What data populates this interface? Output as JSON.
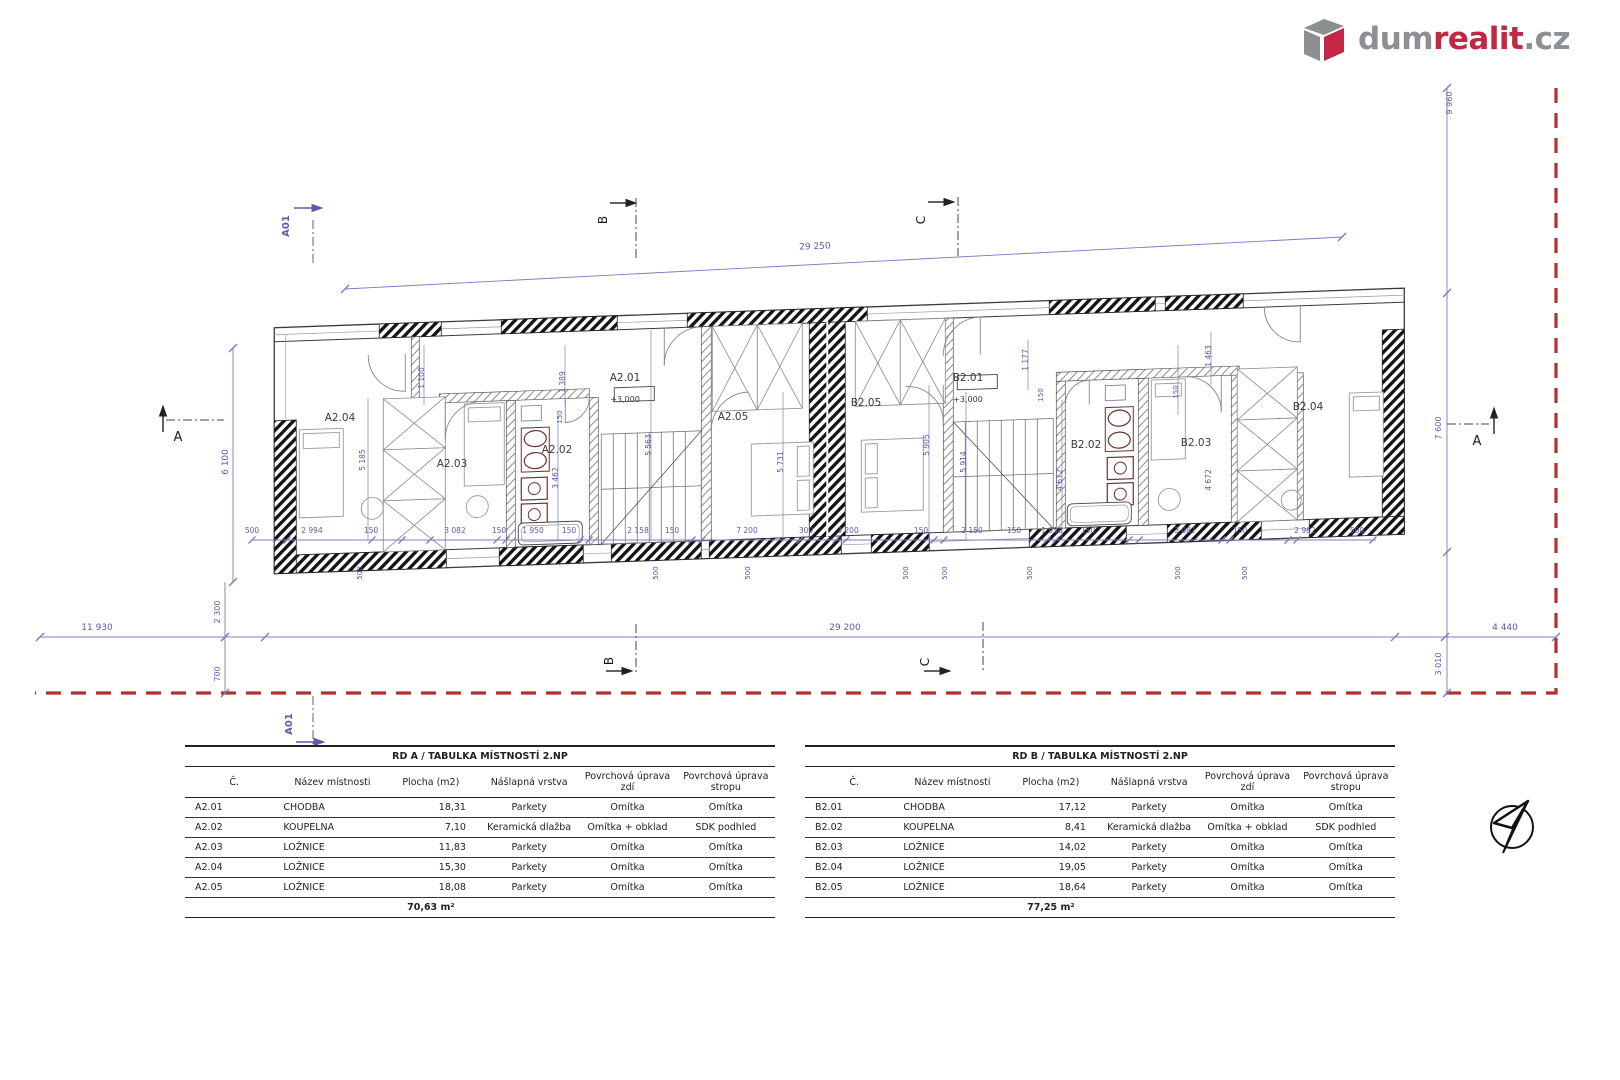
{
  "logo": {
    "dum": "dum",
    "realit": "realit",
    "cz": ".cz"
  },
  "tables": {
    "a": {
      "title": "RD A / TABULKA MÍSTNOSTÍ 2.NP",
      "headers": [
        "Č.",
        "Název místnosti",
        "Plocha (m2)",
        "Nášlapná vrstva",
        "Povrchová úprava zdí",
        "Povrchová úprava stropu"
      ],
      "rows": [
        [
          "A2.01",
          "CHODBA",
          "18,31",
          "Parkety",
          "Omítka",
          "Omítka"
        ],
        [
          "A2.02",
          "KOUPELNA",
          "7,10",
          "Keramická dlažba",
          "Omítka + obklad",
          "SDK podhled"
        ],
        [
          "A2.03",
          "LOŽNICE",
          "11,83",
          "Parkety",
          "Omítka",
          "Omítka"
        ],
        [
          "A2.04",
          "LOŽNICE",
          "15,30",
          "Parkety",
          "Omítka",
          "Omítka"
        ],
        [
          "A2.05",
          "LOŽNICE",
          "18,08",
          "Parkety",
          "Omítka",
          "Omítka"
        ]
      ],
      "total": "70,63 m²"
    },
    "b": {
      "title": "RD B / TABULKA MÍSTNOSTÍ 2.NP",
      "headers": [
        "Č.",
        "Název místnosti",
        "Plocha (m2)",
        "Nášlapná vrstva",
        "Povrchová úprava zdí",
        "Povrchová úprava stropu"
      ],
      "rows": [
        [
          "B2.01",
          "CHODBA",
          "17,12",
          "Parkety",
          "Omítka",
          "Omítka"
        ],
        [
          "B2.02",
          "KOUPELNA",
          "8,41",
          "Keramická dlažba",
          "Omítka + obklad",
          "SDK podhled"
        ],
        [
          "B2.03",
          "LOŽNICE",
          "14,02",
          "Parkety",
          "Omítka",
          "Omítka"
        ],
        [
          "B2.04",
          "LOŽNICE",
          "19,05",
          "Parkety",
          "Omítka",
          "Omítka"
        ],
        [
          "B2.05",
          "LOŽNICE",
          "18,64",
          "Parkety",
          "Omítka",
          "Omítka"
        ]
      ],
      "total": "77,25 m²"
    }
  },
  "plan": {
    "colors": {
      "dimension": "#5b5baa",
      "boundary": "#b23030",
      "wall": "#3a3a3a"
    },
    "labels": [
      {
        "n": "room-label-a2-04",
        "t": "A2.04",
        "x": 340,
        "y": 421,
        "cls": "room",
        "s": 10.5
      },
      {
        "n": "room-label-a2-03",
        "t": "A2.03",
        "x": 452,
        "y": 467,
        "cls": "room",
        "s": 10.5
      },
      {
        "n": "room-label-a2-02",
        "t": "A2.02",
        "x": 557,
        "y": 453,
        "cls": "room",
        "s": 10.5
      },
      {
        "n": "room-label-a2-01",
        "t": "A2.01",
        "x": 625,
        "y": 381,
        "cls": "room",
        "s": 10.5
      },
      {
        "n": "room-label-a2-05",
        "t": "A2.05",
        "x": 733,
        "y": 420,
        "cls": "room",
        "s": 10.5
      },
      {
        "n": "room-label-b2-05",
        "t": "B2.05",
        "x": 866,
        "y": 406,
        "cls": "room",
        "s": 10.5
      },
      {
        "n": "room-label-b2-01",
        "t": "B2.01",
        "x": 968,
        "y": 381,
        "cls": "room",
        "s": 10.5
      },
      {
        "n": "room-label-b2-02",
        "t": "B2.02",
        "x": 1086,
        "y": 448,
        "cls": "room",
        "s": 10.5
      },
      {
        "n": "room-label-b2-03",
        "t": "B2.03",
        "x": 1196,
        "y": 446,
        "cls": "room",
        "s": 10.5
      },
      {
        "n": "room-label-b2-04",
        "t": "B2.04",
        "x": 1308,
        "y": 410,
        "cls": "room",
        "s": 10.5
      },
      {
        "n": "elevation-label-a",
        "t": "+3,000",
        "x": 625,
        "y": 402,
        "cls": "room",
        "s": 8
      },
      {
        "n": "elevation-label-b",
        "t": "+3,000",
        "x": 968,
        "y": 402,
        "cls": "room",
        "s": 8
      },
      {
        "n": "dim-total-top",
        "t": "29 250",
        "x": 815,
        "y": 249,
        "cls": "dim",
        "s": 9,
        "r": -2.5
      },
      {
        "n": "dim-left-height",
        "t": "6 100",
        "x": 228,
        "y": 462,
        "cls": "dim",
        "s": 9,
        "r": -90
      },
      {
        "n": "dim-left-offset",
        "t": "11 930",
        "x": 97,
        "y": 630,
        "cls": "dim",
        "s": 9
      },
      {
        "n": "dim-building-length",
        "t": "29 200",
        "x": 845,
        "y": 630,
        "cls": "dim",
        "s": 9
      },
      {
        "n": "dim-right-offset",
        "t": "4 440",
        "x": 1505,
        "y": 630,
        "cls": "dim",
        "s": 9
      },
      {
        "n": "dim-2300",
        "t": "2 300",
        "x": 220,
        "y": 612,
        "cls": "dim",
        "s": 8,
        "r": -90
      },
      {
        "n": "dim-700",
        "t": "700",
        "x": 220,
        "y": 674,
        "cls": "dim",
        "s": 8,
        "r": -90
      },
      {
        "n": "dim-3010",
        "t": "3 010",
        "x": 1441,
        "y": 664,
        "cls": "dim",
        "s": 8,
        "r": -90
      },
      {
        "n": "dim-9960",
        "t": "9 960",
        "x": 1452,
        "y": 103,
        "cls": "dim",
        "s": 8,
        "r": -90
      },
      {
        "n": "dim-7600",
        "t": "7 600",
        "x": 1441,
        "y": 428,
        "cls": "dim",
        "s": 8,
        "r": -90
      },
      {
        "n": "dim-1100",
        "t": "1 100",
        "x": 424,
        "y": 378,
        "cls": "dim",
        "s": 7.5,
        "r": -90
      },
      {
        "n": "dim-5185",
        "t": "5 185",
        "x": 365,
        "y": 460,
        "cls": "dim",
        "s": 7.5,
        "r": -90
      },
      {
        "n": "dim-3462",
        "t": "3 462",
        "x": 558,
        "y": 478,
        "cls": "dim",
        "s": 7.5,
        "r": -90
      },
      {
        "n": "dim-1389",
        "t": "1 389",
        "x": 565,
        "y": 382,
        "cls": "dim",
        "s": 7.5,
        "r": -90
      },
      {
        "n": "dim-5563",
        "t": "5 563",
        "x": 651,
        "y": 445,
        "cls": "dim",
        "s": 7.5,
        "r": -90
      },
      {
        "n": "dim-5731",
        "t": "5 731",
        "x": 783,
        "y": 462,
        "cls": "dim",
        "s": 7.5,
        "r": -90
      },
      {
        "n": "dim-5905",
        "t": "5 905",
        "x": 929,
        "y": 445,
        "cls": "dim",
        "s": 7.5,
        "r": -90
      },
      {
        "n": "dim-5914",
        "t": "5 914",
        "x": 966,
        "y": 462,
        "cls": "dim",
        "s": 7.5,
        "r": -90
      },
      {
        "n": "dim-1177",
        "t": "1 177",
        "x": 1028,
        "y": 360,
        "cls": "dim",
        "s": 7.5,
        "r": -90
      },
      {
        "n": "dim-1463",
        "t": "1 463",
        "x": 1211,
        "y": 356,
        "cls": "dim",
        "s": 7.5,
        "r": -90
      },
      {
        "n": "dim-4672-a",
        "t": "4 672",
        "x": 1062,
        "y": 480,
        "cls": "dim",
        "s": 7.5,
        "r": -90
      },
      {
        "n": "dim-4672-b",
        "t": "4 672",
        "x": 1211,
        "y": 480,
        "cls": "dim",
        "s": 7.5,
        "r": -90
      },
      {
        "n": "dim-150-a",
        "t": "150",
        "x": 562,
        "y": 417,
        "cls": "dim",
        "s": 7,
        "r": -90
      },
      {
        "n": "dim-150-b",
        "t": "150",
        "x": 1043,
        "y": 395,
        "cls": "dim",
        "s": 7,
        "r": -90
      },
      {
        "n": "dim-150-c",
        "t": "150",
        "x": 1178,
        "y": 392,
        "cls": "dim",
        "s": 7,
        "r": -90
      },
      {
        "n": "dim-row-1",
        "t": "500",
        "x": 252,
        "y": 533,
        "cls": "dim",
        "s": 7.5
      },
      {
        "n": "dim-row-2",
        "t": "2 994",
        "x": 312,
        "y": 533,
        "cls": "dim",
        "s": 7.5
      },
      {
        "n": "dim-row-3",
        "t": "150",
        "x": 371,
        "y": 533,
        "cls": "dim",
        "s": 7.5
      },
      {
        "n": "dim-row-4",
        "t": "3 082",
        "x": 455,
        "y": 533,
        "cls": "dim",
        "s": 7.5
      },
      {
        "n": "dim-row-5",
        "t": "150",
        "x": 499,
        "y": 533,
        "cls": "dim",
        "s": 7.5
      },
      {
        "n": "dim-row-6",
        "t": "1 950",
        "x": 533,
        "y": 533,
        "cls": "dim",
        "s": 7.5
      },
      {
        "n": "dim-row-7",
        "t": "150",
        "x": 569,
        "y": 533,
        "cls": "dim",
        "s": 7.5
      },
      {
        "n": "dim-row-8",
        "t": "2 158",
        "x": 638,
        "y": 533,
        "cls": "dim",
        "s": 7.5
      },
      {
        "n": "dim-row-9",
        "t": "150",
        "x": 672,
        "y": 533,
        "cls": "dim",
        "s": 7.5
      },
      {
        "n": "dim-row-10",
        "t": "7 200",
        "x": 747,
        "y": 533,
        "cls": "dim",
        "s": 7.5
      },
      {
        "n": "dim-row-11",
        "t": "300",
        "x": 806,
        "y": 533,
        "cls": "dim",
        "s": 7.5
      },
      {
        "n": "dim-row-12",
        "t": "3 200",
        "x": 848,
        "y": 533,
        "cls": "dim",
        "s": 7.5
      },
      {
        "n": "dim-row-13",
        "t": "150",
        "x": 921,
        "y": 533,
        "cls": "dim",
        "s": 7.5
      },
      {
        "n": "dim-row-14",
        "t": "2 150",
        "x": 972,
        "y": 533,
        "cls": "dim",
        "s": 7.5
      },
      {
        "n": "dim-row-15",
        "t": "150",
        "x": 1014,
        "y": 533,
        "cls": "dim",
        "s": 7.5
      },
      {
        "n": "dim-row-16",
        "t": "1 950",
        "x": 1052,
        "y": 533,
        "cls": "dim",
        "s": 7.5
      },
      {
        "n": "dim-row-17",
        "t": "150",
        "x": 1088,
        "y": 533,
        "cls": "dim",
        "s": 7.5
      },
      {
        "n": "dim-row-18",
        "t": "3 082",
        "x": 1185,
        "y": 533,
        "cls": "dim",
        "s": 7.5
      },
      {
        "n": "dim-row-19",
        "t": "150",
        "x": 1240,
        "y": 533,
        "cls": "dim",
        "s": 7.5
      },
      {
        "n": "dim-row-20",
        "t": "2 962",
        "x": 1305,
        "y": 533,
        "cls": "dim",
        "s": 7.5
      },
      {
        "n": "dim-row-21",
        "t": "500",
        "x": 1357,
        "y": 533,
        "cls": "dim",
        "s": 7.5
      },
      {
        "n": "dim-500-1",
        "t": "500",
        "x": 362,
        "y": 573,
        "cls": "dim",
        "s": 7,
        "r": -90
      },
      {
        "n": "dim-500-2",
        "t": "500",
        "x": 658,
        "y": 573,
        "cls": "dim",
        "s": 7,
        "r": -90
      },
      {
        "n": "dim-500-3",
        "t": "500",
        "x": 750,
        "y": 573,
        "cls": "dim",
        "s": 7,
        "r": -90
      },
      {
        "n": "dim-500-4",
        "t": "500",
        "x": 908,
        "y": 573,
        "cls": "dim",
        "s": 7,
        "r": -90
      },
      {
        "n": "dim-500-5",
        "t": "500",
        "x": 947,
        "y": 573,
        "cls": "dim",
        "s": 7,
        "r": -90
      },
      {
        "n": "dim-500-6",
        "t": "500",
        "x": 1032,
        "y": 573,
        "cls": "dim",
        "s": 7,
        "r": -90
      },
      {
        "n": "dim-500-7",
        "t": "500",
        "x": 1180,
        "y": 573,
        "cls": "dim",
        "s": 7,
        "r": -90
      },
      {
        "n": "dim-500-8",
        "t": "500",
        "x": 1247,
        "y": 573,
        "cls": "dim",
        "s": 7,
        "r": -90
      },
      {
        "n": "section-marker-a01-top",
        "t": "A01",
        "x": 289,
        "y": 226,
        "cls": "dimb",
        "s": 10,
        "r": -90
      },
      {
        "n": "section-marker-a01-bottom",
        "t": "A01",
        "x": 292,
        "y": 724,
        "cls": "dimb",
        "s": 10,
        "r": -90
      },
      {
        "n": "section-marker-b-top",
        "t": "B",
        "x": 607,
        "y": 220,
        "cls": "marker",
        "s": 12,
        "r": -90
      },
      {
        "n": "section-marker-b-bottom",
        "t": "B",
        "x": 613,
        "y": 661,
        "cls": "marker",
        "s": 12,
        "r": -90
      },
      {
        "n": "section-marker-c-top",
        "t": "C",
        "x": 925,
        "y": 220,
        "cls": "marker",
        "s": 12,
        "r": -90
      },
      {
        "n": "section-marker-c-bottom",
        "t": "C",
        "x": 929,
        "y": 662,
        "cls": "marker",
        "s": 12,
        "r": -90
      },
      {
        "n": "section-marker-a-left",
        "t": "A",
        "x": 178,
        "y": 441,
        "cls": "marker",
        "s": 13
      },
      {
        "n": "section-marker-a-right",
        "t": "A",
        "x": 1477,
        "y": 445,
        "cls": "marker",
        "s": 13
      }
    ]
  }
}
